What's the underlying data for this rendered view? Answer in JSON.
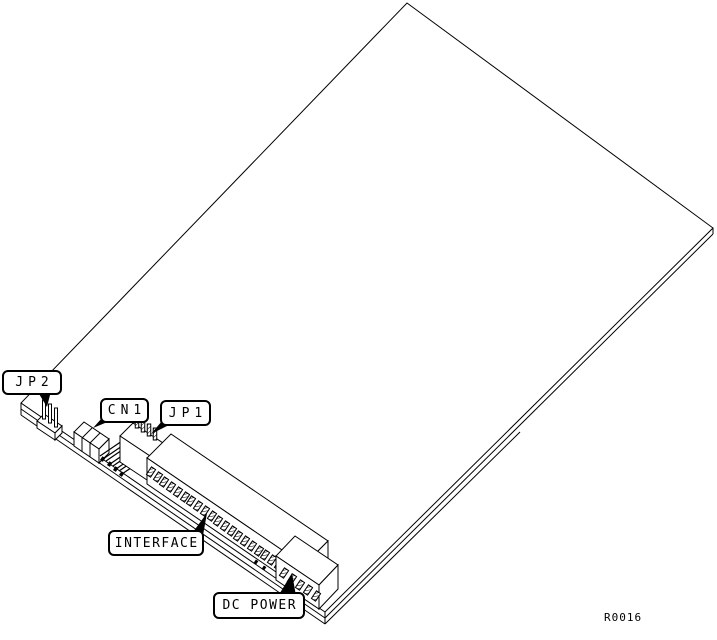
{
  "figure": {
    "callouts": {
      "jp2": "JP2",
      "cn1": "CN1",
      "jp1": "JP1",
      "interface": "INTERFACE",
      "dc_power": "DC POWER"
    },
    "reference_code": "R0016",
    "colors": {
      "line": "#000000",
      "background": "#ffffff"
    }
  }
}
